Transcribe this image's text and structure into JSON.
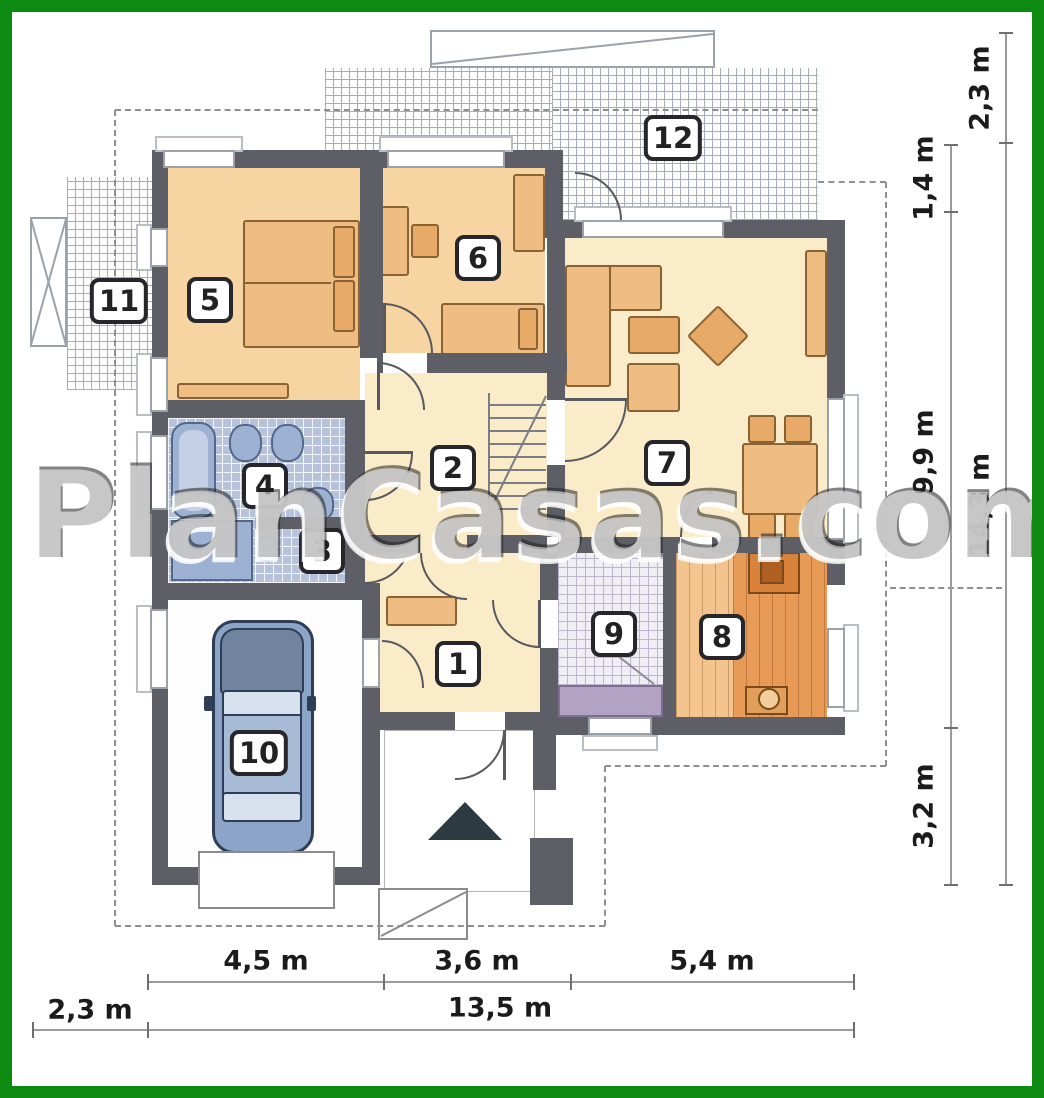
{
  "watermark": "PlanCasas.com",
  "room_labels": {
    "r1": "1",
    "r2": "2",
    "r3": "3",
    "r4": "4",
    "r5": "5",
    "r6": "6",
    "r7": "7",
    "r8": "8",
    "r9": "9",
    "r10": "10",
    "r11": "11",
    "r12": "12"
  },
  "dimensions": {
    "right_inner": [
      "1,4 m",
      "9,9 m",
      "3,2 m"
    ],
    "right_outer": [
      "2,3 m",
      "14,3 m"
    ],
    "bottom_row1": [
      "4,5 m",
      "3,6 m",
      "5,4 m"
    ],
    "bottom_row2": [
      "2,3 m",
      "13,5 m"
    ]
  },
  "colors": {
    "frame_green": "#0d8a11",
    "wall_gray": "#5e5f66",
    "bedroom_tan": "#f6d5a2",
    "hall_cream": "#faecc9",
    "bath_tile_blue": "#b6c3db",
    "utility_tile": "#efeef4",
    "utility_counter_lilac": "#b2a3c4",
    "plank_light": "#f3c48e",
    "plank_dark": "#e89b57",
    "furniture_orange": "#efbd82",
    "car_blue": "#8ba4c7",
    "dimension_line": "#9b9b9b",
    "dashed_outline": "#8f8f8f"
  }
}
